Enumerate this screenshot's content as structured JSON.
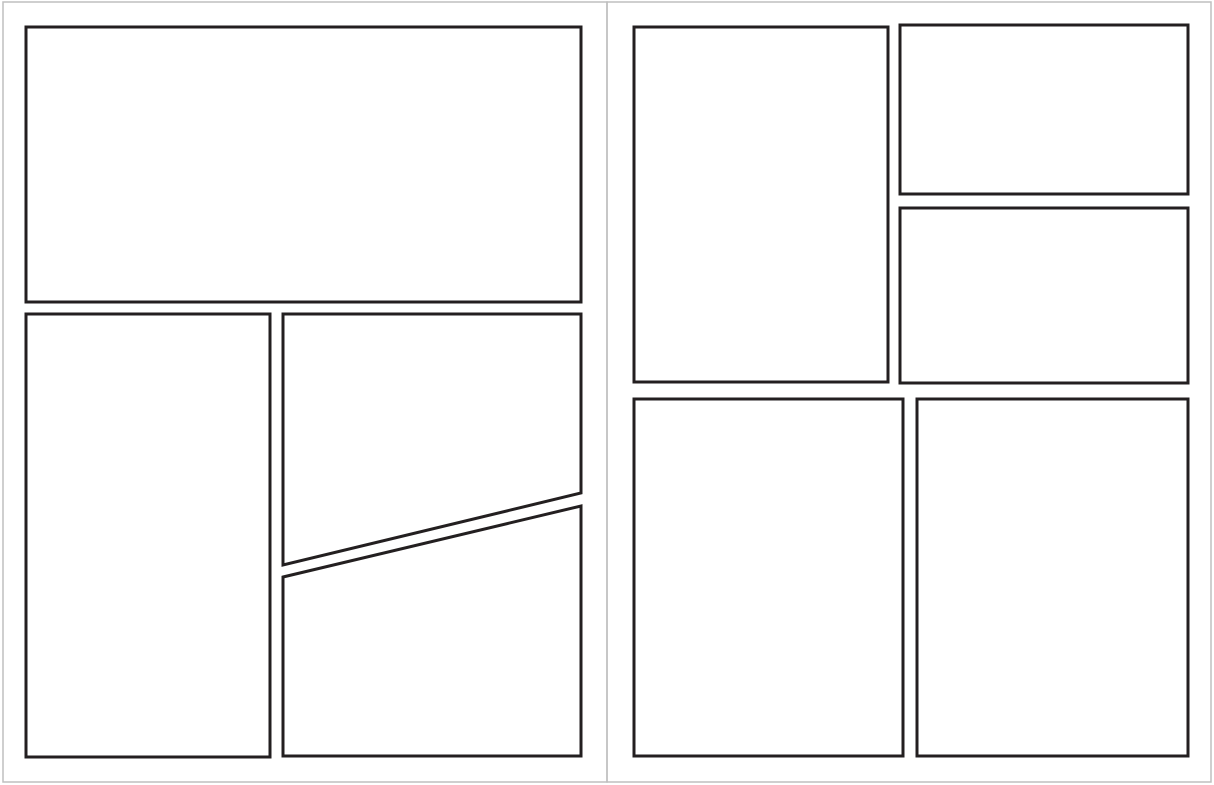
{
  "document": {
    "kind": "comic-page-template-spread",
    "page_count": 2,
    "panel_count": 9,
    "text_content": ""
  },
  "canvas": {
    "width": 1214,
    "height": 785,
    "background": "#ffffff"
  },
  "colors": {
    "panel_border": "#231f20",
    "panel_fill": "#ffffff",
    "page_edge": "#bfbfbf"
  },
  "stroke": {
    "panel_border_width": 3,
    "page_edge_width": 1.5
  },
  "pages": [
    {
      "name": "left-page",
      "edge_rect": [
        3,
        2,
        607,
        782
      ],
      "panels": [
        {
          "name": "panel-1-wide-top",
          "points": [
            [
              26,
              27
            ],
            [
              581,
              27
            ],
            [
              581,
              302
            ],
            [
              26,
              302
            ]
          ]
        },
        {
          "name": "panel-2-tall-left",
          "points": [
            [
              26,
              314
            ],
            [
              270,
              314
            ],
            [
              270,
              757
            ],
            [
              26,
              757
            ]
          ]
        },
        {
          "name": "panel-3-right-slant-bottom",
          "points": [
            [
              283,
              314
            ],
            [
              581,
              314
            ],
            [
              581,
              493
            ],
            [
              283,
              565
            ]
          ]
        },
        {
          "name": "panel-4-right-slant-top",
          "points": [
            [
              283,
              577
            ],
            [
              581,
              506
            ],
            [
              581,
              756
            ],
            [
              283,
              756
            ]
          ]
        }
      ]
    },
    {
      "name": "right-page",
      "edge_rect": [
        607,
        2,
        1211,
        782
      ],
      "panels": [
        {
          "name": "panel-5-tall-top-left",
          "points": [
            [
              634,
              27
            ],
            [
              888,
              27
            ],
            [
              888,
              382
            ],
            [
              634,
              382
            ]
          ]
        },
        {
          "name": "panel-6-top-right-upper",
          "points": [
            [
              900,
              25
            ],
            [
              1188,
              25
            ],
            [
              1188,
              194
            ],
            [
              900,
              194
            ]
          ]
        },
        {
          "name": "panel-7-top-right-lower",
          "points": [
            [
              900,
              208
            ],
            [
              1188,
              208
            ],
            [
              1188,
              383
            ],
            [
              900,
              383
            ]
          ]
        },
        {
          "name": "panel-8-bottom-left",
          "points": [
            [
              634,
              399
            ],
            [
              903,
              399
            ],
            [
              903,
              756
            ],
            [
              634,
              756
            ]
          ]
        },
        {
          "name": "panel-9-bottom-right",
          "points": [
            [
              917,
              399
            ],
            [
              1188,
              399
            ],
            [
              1188,
              756
            ],
            [
              917,
              756
            ]
          ]
        }
      ]
    }
  ]
}
